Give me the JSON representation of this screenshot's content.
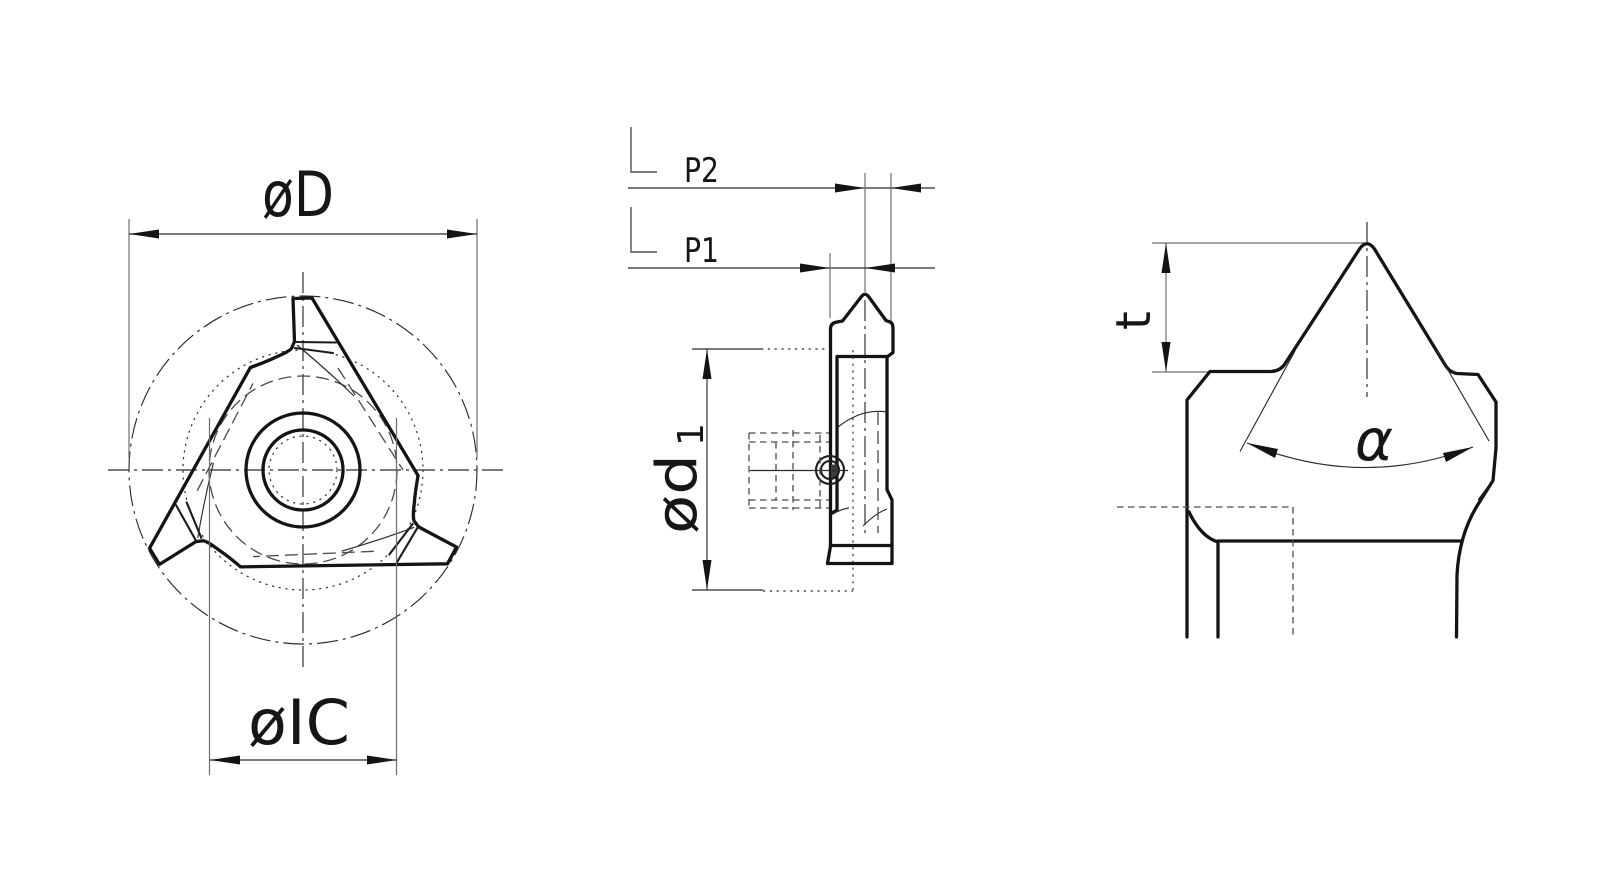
{
  "drawing": {
    "description": "three-view technical line drawing of a triangular threading insert",
    "colors": {
      "background": "#ffffff",
      "main_line": "#141414",
      "thin_line": "#2b2b2b",
      "helper_line": "#6f6f6f"
    }
  },
  "front_view": {
    "dim_outer_diameter": "øD",
    "dim_inscribed_circle": "øIC"
  },
  "side_view": {
    "dim_p2": "P2",
    "dim_p1": "P1",
    "dim_d1_base": "ød",
    "dim_d1_subscript": "1"
  },
  "detail_view": {
    "dim_tooth_height": "t",
    "dim_flank_angle": "α"
  }
}
